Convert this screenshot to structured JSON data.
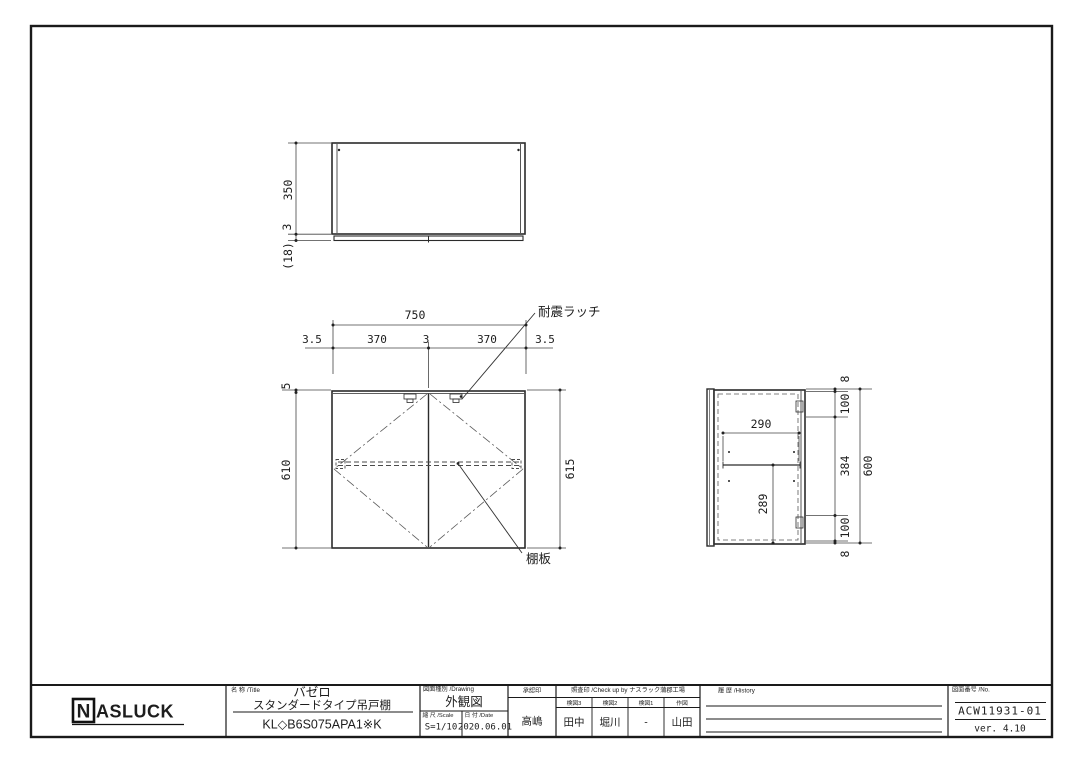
{
  "drawing": {
    "views": {
      "top": {
        "depth": "350",
        "gap": "3",
        "door_thickness": "(18)"
      },
      "front": {
        "width_total": "750",
        "segments": [
          "3.5",
          "370",
          "3",
          "370",
          "3.5"
        ],
        "door_top_gap": "5",
        "door_height": "610",
        "carcass_height": "615",
        "latch_label": "耐震ラッチ",
        "shelf_label": "棚板"
      },
      "side": {
        "shelf_depth": "290",
        "shelf_height": "289",
        "chain": [
          "8",
          "100",
          "384",
          "100",
          "8"
        ],
        "overall_height": "600"
      }
    }
  },
  "title_block": {
    "logo_n": "N",
    "logo_rest": "ASLUCK",
    "name_label": "名 称 /Title",
    "series": "バゼロ",
    "product": "スタンダードタイプ吊戸棚",
    "model": "KL◇B6S075APA1※K",
    "drawing_label": "図面種別 /Drawing",
    "drawing_type": "外観図",
    "scale_label": "縮 尺 /Scale",
    "scale_value": "S=1/10",
    "date_label": "日 付 /Date",
    "date_value": "2020.06.01",
    "approval_label": "承認印",
    "approval_value": "高嶋",
    "check_label": "照査印 /Check up by ナスラック蒲郡工場",
    "check_columns": [
      {
        "label": "検図3",
        "value": "田中"
      },
      {
        "label": "検図2",
        "value": "堀川"
      },
      {
        "label": "検図1",
        "value": "-"
      },
      {
        "label": "作図",
        "value": "山田"
      }
    ],
    "history_label": "履 歴 /History",
    "no_label": "図面番号 /No.",
    "drawing_no": "ACW11931-01",
    "version": "ver. 4.10"
  }
}
